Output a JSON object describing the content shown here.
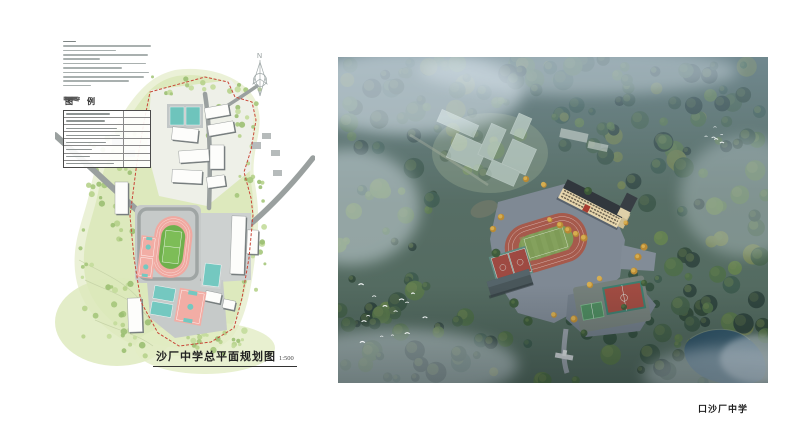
{
  "site_plan": {
    "title": "沙厂中学总平面规划图",
    "scale": "1:500",
    "legend_title": "图 例",
    "north_label": "N",
    "legend_row_count": 8,
    "notes_line_count": 11
  },
  "rendering": {
    "caption": "口沙厂中学"
  },
  "colors": {
    "boundary_red": "#c94638",
    "plan_vegetation": "#dde9bd",
    "plan_road_gray": "#9aa09f",
    "track_surface_pink": "#f0a9a1",
    "track_infield_green": "#6fb04c",
    "court_teal": "#74c8c0",
    "render_track_red": "#a65a4c",
    "render_infield_green": "#7e9b57",
    "render_building_cream": "#e8d7ae",
    "render_court_red": "#a14c42",
    "render_court_green": "#4e8a5f",
    "render_pond_blue": "#2c4f63",
    "render_forest_green": "#3a5743",
    "render_mist_blue": "#cfdde9"
  }
}
